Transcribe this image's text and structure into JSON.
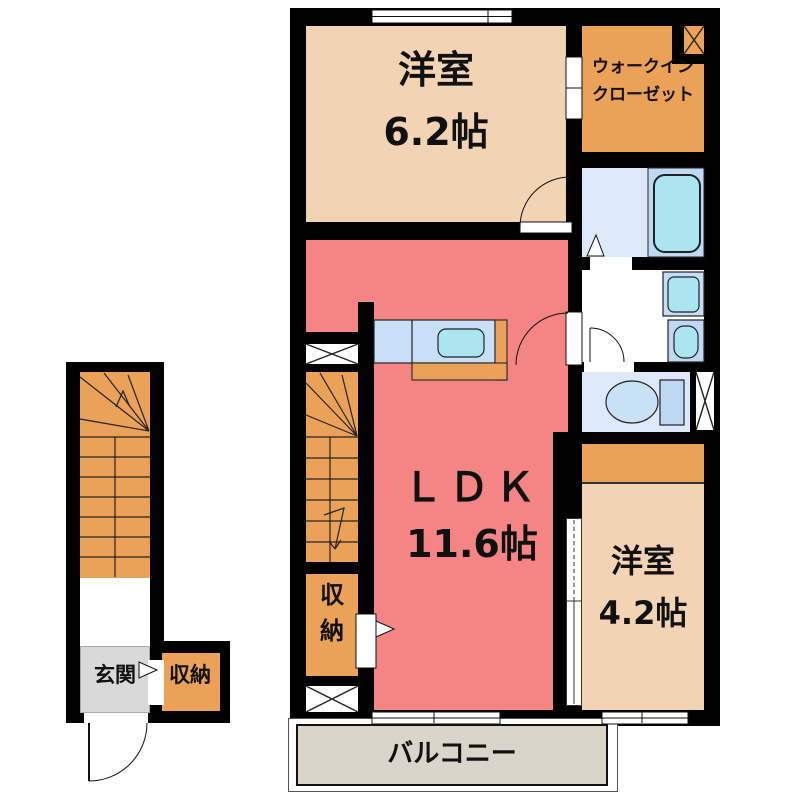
{
  "rooms": {
    "bedroom_main": {
      "label": "洋室",
      "size": "6.2帖"
    },
    "walk_in_closet": {
      "line1": "ウォークイン",
      "line2": "クローゼット"
    },
    "ldk": {
      "label": "ＬＤＫ",
      "size": "11.6帖"
    },
    "bedroom_second": {
      "label": "洋室",
      "size": "4.2帖"
    },
    "storage_hall": {
      "label": "収納",
      "chars": [
        "収",
        "納"
      ]
    },
    "balcony": {
      "label": "バルコニー"
    },
    "entrance": {
      "label": "玄関"
    },
    "storage_entrance": {
      "label": "収納"
    }
  },
  "fixtures": [
    "bathtub",
    "toilet",
    "wash-basin",
    "washing-machine",
    "kitchen-sink",
    "staircase-upper",
    "staircase-lower"
  ],
  "colors": {
    "wall": "#000000",
    "bedroom_peach": "#F2D4B5",
    "ldk_pink": "#F58585",
    "storage_orange": "#EBA258",
    "wet_room_blue": "#DCE9F8",
    "fixture_blue": "#BFD9F3",
    "fixture_cyan": "#ABE6F0",
    "kitchen_counter": "#C9DFF7",
    "balcony_beige": "#DBD4C8",
    "entrance_grey": "#D9D9D9"
  }
}
